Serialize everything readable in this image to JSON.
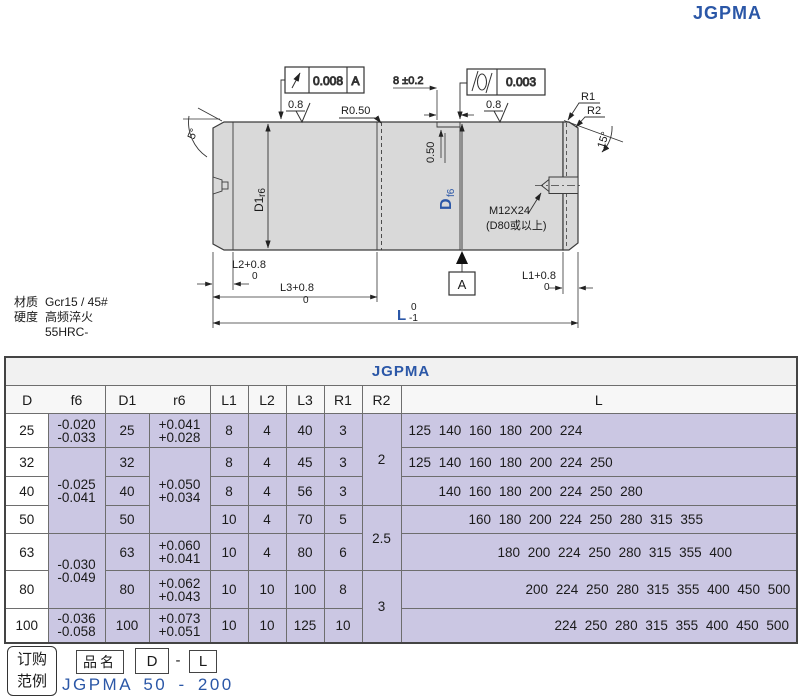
{
  "page": {
    "brand": "JGPMA"
  },
  "colors": {
    "accent_blue": "#2b57a7",
    "cell_purple": "#cbc7e3",
    "shaft_gray": "#d9d9d9"
  },
  "drawing": {
    "runout": {
      "value": "0.008",
      "datum": "A"
    },
    "cylindricity": {
      "value": "0.003"
    },
    "groove_width": "8 ±0.2",
    "roughness_left": "0.8",
    "roughness_right": "0.8",
    "radius_groove": "R0.50",
    "groove_depth": "0.50",
    "d1_label": "D1",
    "d1_fit": "r6",
    "d_label": "D",
    "d_fit": "f6",
    "r1_label": "R1",
    "r2_label": "R2",
    "angle_right": "15°",
    "angle_left": "5°",
    "thread_spec": "M12X24",
    "thread_note": "(D80或以上)",
    "datum_flag": "A",
    "dim_l2": "L2+0.8",
    "dim_l2_sub": "0",
    "dim_l3": "L3+0.8",
    "dim_l3_sub": "0",
    "dim_l1": "L1+0.8",
    "dim_l1_sub": "0",
    "dim_l": "L",
    "dim_l_sup": "0",
    "dim_l_sub": "-1",
    "material_label": "材质",
    "material_value": "Gcr15 / 45#",
    "hardness_label": "硬度",
    "hardness_value": "高频淬火",
    "hardness_value2": "55HRC-"
  },
  "table": {
    "title": "JGPMA",
    "headers": {
      "d": "D",
      "f6": "f6",
      "d1": "D1",
      "r6": "r6",
      "l1": "L1",
      "l2": "L2",
      "l3": "L3",
      "r1": "R1",
      "r2": "R2",
      "l": "L"
    },
    "rows": [
      {
        "d": "25",
        "f6a": "-0.020",
        "f6b": "-0.033",
        "d1": "25",
        "r6a": "+0.041",
        "r6b": "+0.028",
        "l1": "8",
        "l2": "4",
        "l3": "40",
        "r1": "3",
        "r2": "2",
        "l": "125 140 160 180 200 224"
      },
      {
        "d": "32",
        "f6a": "-0.025",
        "f6b": "-0.041",
        "d1": "32",
        "r6a": "+0.050",
        "r6b": "+0.034",
        "l1": "8",
        "l2": "4",
        "l3": "45",
        "r1": "3",
        "l": "125 140 160 180 200 224 250"
      },
      {
        "d": "40",
        "d1": "40",
        "l1": "8",
        "l2": "4",
        "l3": "56",
        "r1": "3",
        "l": "140 160 180 200 224 250 280"
      },
      {
        "d": "50",
        "d1": "50",
        "l1": "10",
        "l2": "4",
        "l3": "70",
        "r1": "5",
        "r2": "2.5",
        "l": "160 180 200 224 250 280 315 355"
      },
      {
        "d": "63",
        "f6a": "-0.030",
        "f6b": "-0.049",
        "d1": "63",
        "r6a": "+0.060",
        "r6b": "+0.041",
        "l1": "10",
        "l2": "4",
        "l3": "80",
        "r1": "6",
        "l": "180 200 224 250 280 315 355 400"
      },
      {
        "d": "80",
        "d1": "80",
        "r6a": "+0.062",
        "r6b": "+0.043",
        "l1": "10",
        "l2": "10",
        "l3": "100",
        "r1": "8",
        "r2": "3",
        "l": "200 224 250 280 315 355 400 450 500"
      },
      {
        "d": "100",
        "f6a": "-0.036",
        "f6b": "-0.058",
        "d1": "100",
        "r6a": "+0.073",
        "r6b": "+0.051",
        "l1": "10",
        "l2": "10",
        "l3": "125",
        "r1": "10",
        "l": "224 250 280 315 355 400 450 500"
      }
    ]
  },
  "order": {
    "box_line1": "订购",
    "box_line2": "范例",
    "product_label": "品名",
    "code_d": "D",
    "code_dash": "-",
    "code_l": "L",
    "example": "JGPMA 50 - 200"
  }
}
